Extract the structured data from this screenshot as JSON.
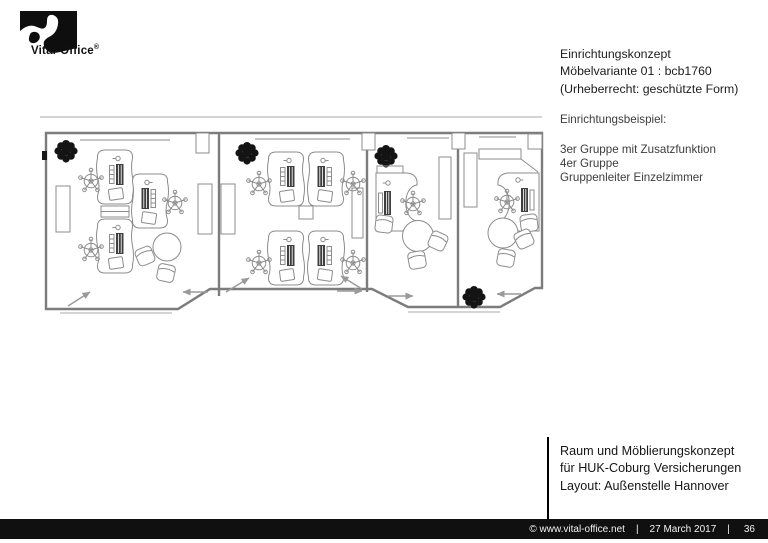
{
  "logo": {
    "brand": "Vital-Office",
    "registered": "®"
  },
  "concept_block": {
    "lines": [
      "Einrichtungskonzept",
      "Möbelvariante 01 : bcb1760",
      "(Urheberrecht: geschützte Form)"
    ]
  },
  "example_block": {
    "title": "Einrichtungsbeispiel:",
    "items": [
      "3er Gruppe mit Zusatzfunktion",
      "4er Gruppe",
      "Gruppenleiter Einzelzimmer"
    ]
  },
  "project_block": {
    "lines": [
      "Raum und Möblierungskonzept",
      "für HUK-Coburg Versicherungen",
      "Layout: Außenstelle Hannover"
    ]
  },
  "footer": {
    "copyright": "©  www.vital-office.net",
    "separator": "|",
    "date": "27 March 2017",
    "page_number": "36"
  },
  "floorplan_colors": {
    "wall": "#7c7c7c",
    "furniture": "#8c8c8c",
    "plant": "#141414",
    "monitor": "#3f3f3f",
    "footer_bg": "#101010"
  }
}
